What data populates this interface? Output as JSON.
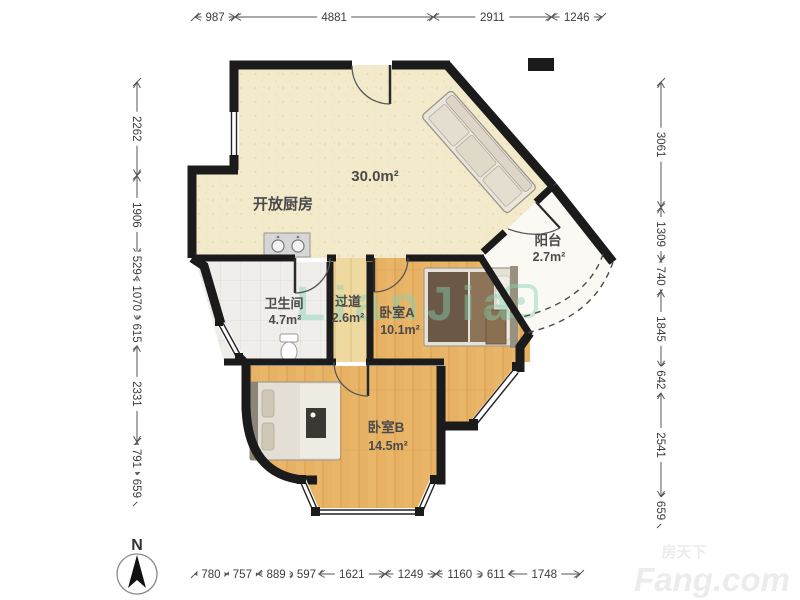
{
  "floorplan": {
    "rooms": [
      {
        "id": "kitchen",
        "label": "开放厨房",
        "area": "30.0m²"
      },
      {
        "id": "balcony",
        "label": "阳台",
        "area": "2.7m²"
      },
      {
        "id": "bathroom",
        "label": "卫生间",
        "area": "4.7m²"
      },
      {
        "id": "hallway",
        "label": "过道",
        "area": "2.6m²"
      },
      {
        "id": "bedroomA",
        "label": "卧室A",
        "area": "10.1m²"
      },
      {
        "id": "bedroomB",
        "label": "卧室B",
        "area": "14.5m²"
      }
    ],
    "dimensions_mm": {
      "top": [
        987,
        4881,
        2911,
        1246
      ],
      "left": [
        2262,
        1906,
        529,
        1070,
        615,
        2331,
        791,
        659
      ],
      "right": [
        3061,
        1309,
        740,
        1845,
        642,
        2541,
        659
      ],
      "bottom": [
        780,
        757,
        889,
        597,
        1621,
        1249,
        1160,
        611,
        1748
      ]
    },
    "compass_label": "N",
    "watermarks": {
      "center": "LianJia",
      "corner_top": "房天下",
      "corner_bottom": "Fang.com"
    },
    "colors": {
      "wall": "#1b1b1b",
      "kitchen_floor": "#f3e9cb",
      "wood_floor": "#e9b569",
      "hall_floor": "#eed9a0",
      "bath_floor": "#f0eeeb",
      "balcony_floor": "#fbf9f4",
      "watermark_green": "#86d3b4",
      "dimension_line": "#555555"
    }
  }
}
